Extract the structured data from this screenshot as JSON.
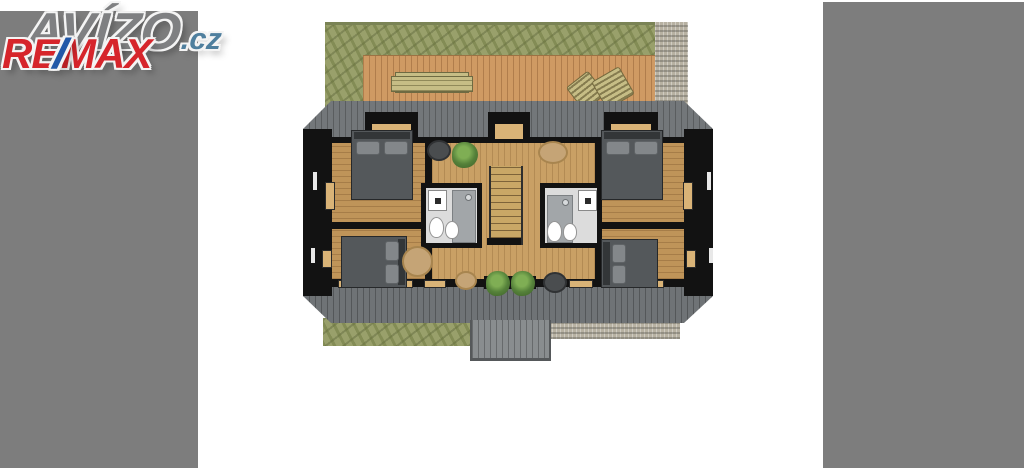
{
  "watermarks": {
    "avizo": {
      "text": "AVÍZO",
      "suffix": ".cz"
    },
    "remax": {
      "re": "RE",
      "slash": "/",
      "max": "MAX"
    }
  },
  "palette": {
    "letterbox": "#7d7d7d",
    "avizo": "#7f8082",
    "avizo-outline": "#f4f4f4",
    "cz": "#4f7f9e",
    "remax-red": "#d6252b",
    "remax-blue": "#2158a8",
    "lawn": "#99a06b",
    "lawn-dark": "#7a8355",
    "deck": "#cf9a63",
    "deck-line": "#b07d4c",
    "bench": "#c6bd85",
    "gravel": "#b7b1a2",
    "roof": "#73777a",
    "roof-dark": "#6f7376",
    "wall": "#121212",
    "floor": "#bf9459",
    "hall-floor": "#c9a065",
    "bed": "#54585b",
    "bed-dark": "#333638",
    "pillow": "#83878a",
    "bath-floor": "#dcdcdc",
    "shower": "#a2a6a9",
    "fixture": "#ffffff",
    "rug": "#c5a476",
    "plant": "#55813a",
    "sill": "#d9b377",
    "stair": "#c9a766",
    "dormer": "#898d8f"
  },
  "scene": {
    "description": "Top-down 3D render of an attic floor plan of a duplex house: four bedrooms with dark beds, two bathrooms, central staircase hall with plants and rugs, rear wooden terrace with bench and two sun loungers, lawn and gravel paths, dark hip roof bands and a rear dormer"
  }
}
